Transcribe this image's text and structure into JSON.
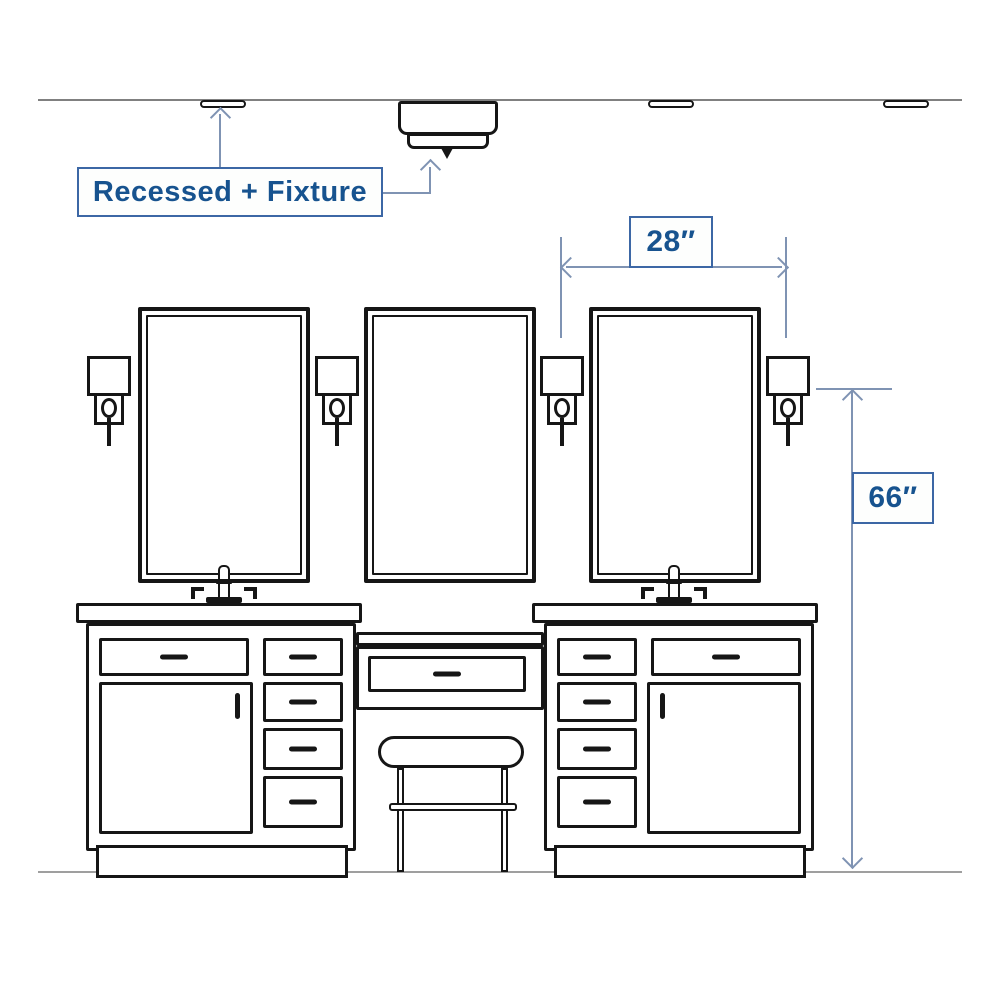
{
  "annotation": {
    "label_recessed_fixture": "Recessed + Fixture",
    "dim_spacing_label": "28″",
    "dim_height_label": "66″"
  },
  "dimensions": {
    "sconce_spacing_inches": 28,
    "sconce_center_height_inches": 66
  },
  "colors": {
    "ink": "#161616",
    "annotation_line": "#7f93b3",
    "annotation_border": "#3c67a5",
    "annotation_text": "#17538f",
    "annotation_fill": "#fdfefd",
    "ceiling_line": "#808080",
    "floor_line": "#9f9f9f",
    "background": "#ffffff"
  }
}
